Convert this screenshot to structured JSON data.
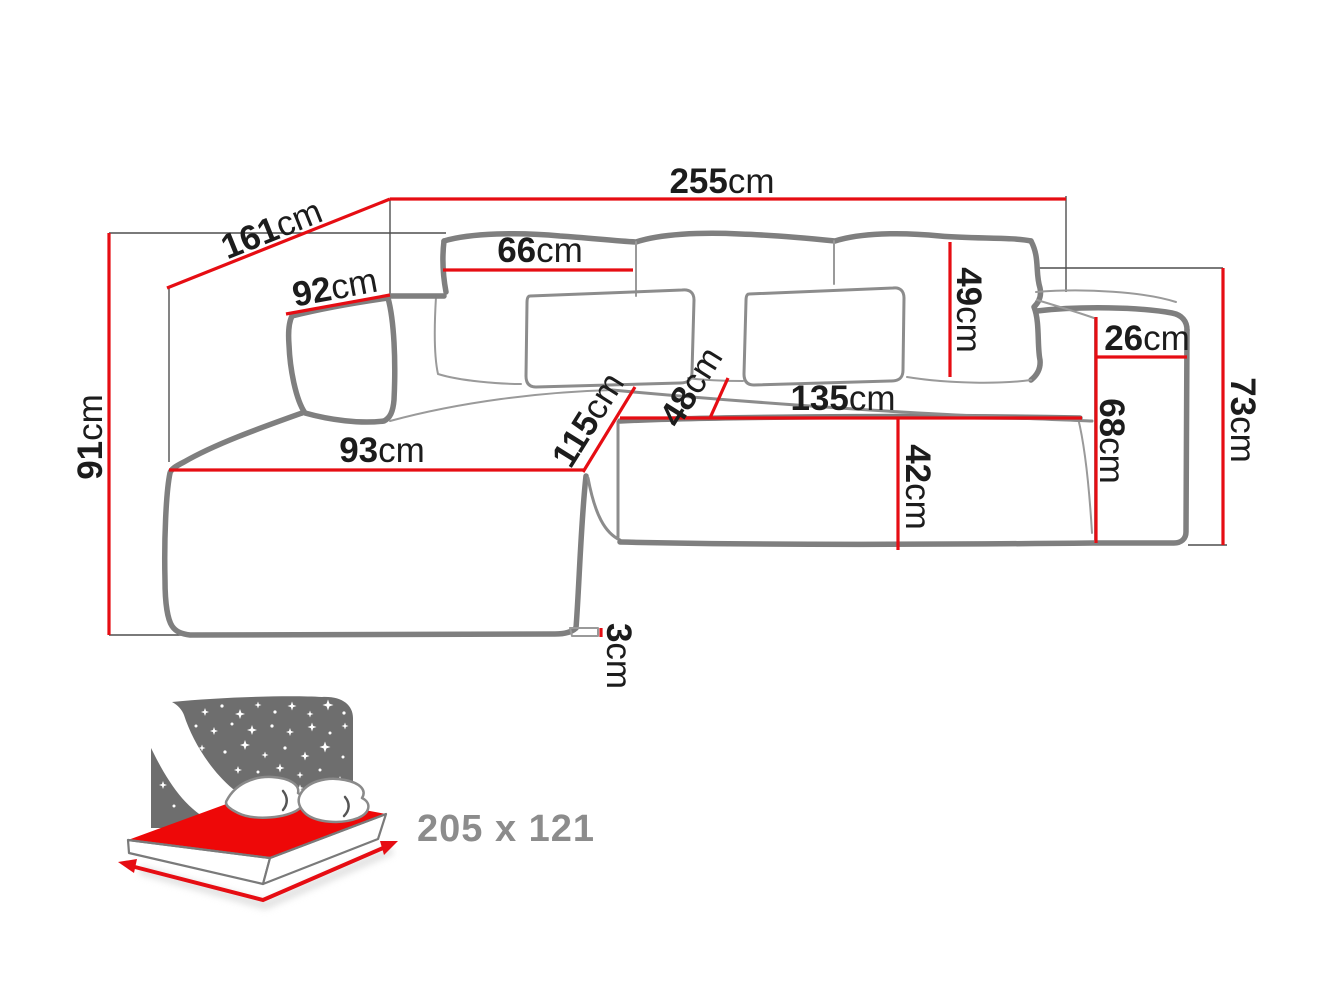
{
  "figure": {
    "type": "corner-sofa dimension diagram",
    "unit": "cm"
  },
  "dims": {
    "width_total": {
      "v": "255",
      "u": "cm"
    },
    "depth_total": {
      "v": "161",
      "u": "cm"
    },
    "height_total": {
      "v": "91",
      "u": "cm"
    },
    "left_armrest": {
      "v": "92",
      "u": "cm"
    },
    "back_cushion_w": {
      "v": "66",
      "u": "cm"
    },
    "back_cushion_h": {
      "v": "49",
      "u": "cm"
    },
    "right_armrest_w": {
      "v": "26",
      "u": "cm"
    },
    "right_side_h": {
      "v": "73",
      "u": "cm"
    },
    "armrest_front_h": {
      "v": "68",
      "u": "cm"
    },
    "chaise_depth": {
      "v": "115",
      "u": "cm"
    },
    "seat_depth": {
      "v": "48",
      "u": "cm"
    },
    "seat_w": {
      "v": "135",
      "u": "cm"
    },
    "seat_front_h": {
      "v": "42",
      "u": "cm"
    },
    "chaise_front_w": {
      "v": "93",
      "u": "cm"
    },
    "leg_h": {
      "v": "3",
      "u": "cm"
    }
  },
  "bed": {
    "sleeping_size": "205 x 121"
  },
  "colors": {
    "dimension_red": "#e60d13",
    "mattress_red": "#ee0808",
    "outline_gray": "#7f7f7f",
    "headboard_gray": "#6e6e6e",
    "label_black": "#1c1c1c",
    "size_text_gray": "#8c8c8c"
  }
}
